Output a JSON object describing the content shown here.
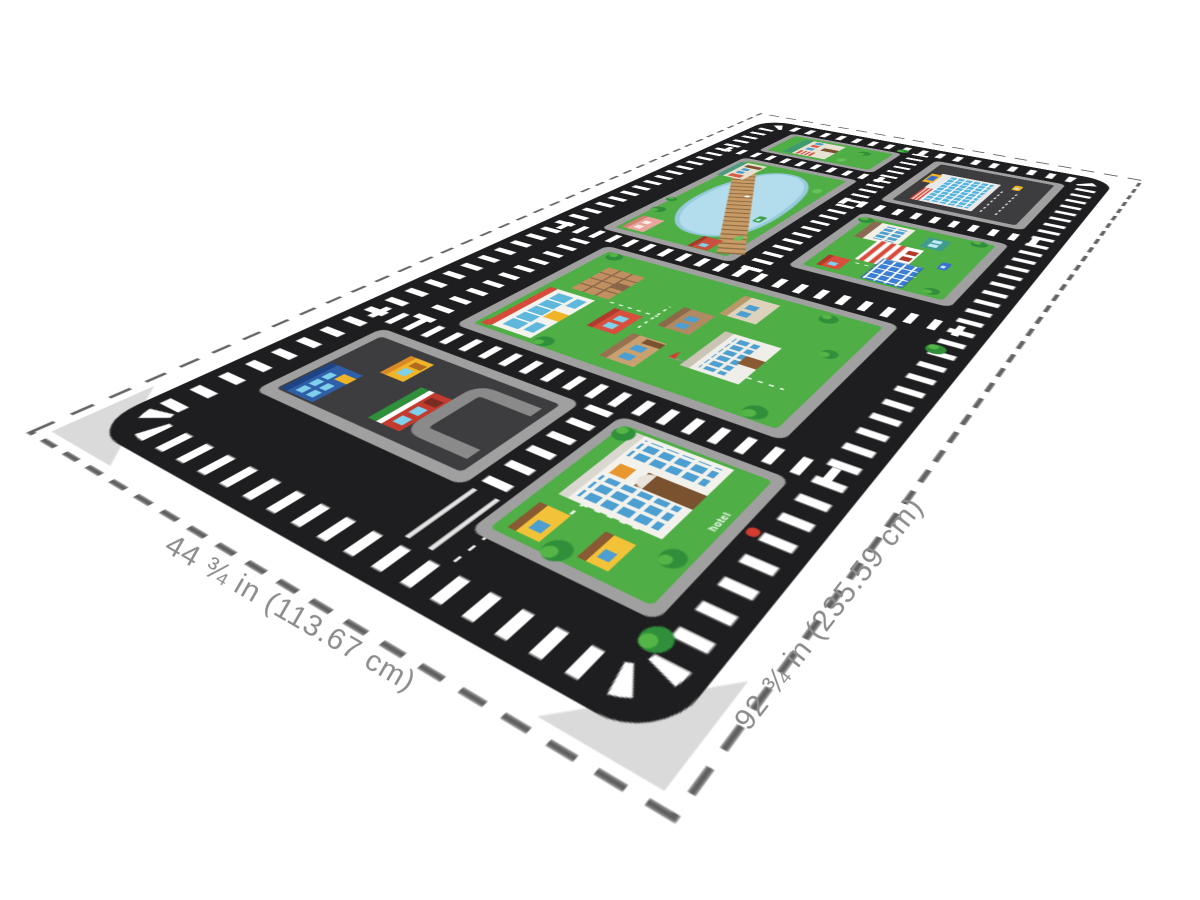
{
  "scene": {
    "type": "product-dimension-view",
    "background": "#ffffff"
  },
  "dimensions": {
    "width_label": "44 ¾ in (113.67 cm)",
    "length_label": "92 ¾ in (235.59 cm)"
  },
  "mat": {
    "labels": {
      "hotel": "hotel"
    },
    "features": [
      "parking-lot-block",
      "hotel-block",
      "city-center-block",
      "pond-park-block",
      "schoolhouse-block",
      "mall-block",
      "supermarket-block",
      "road-crosswalk-stripes",
      "boardwalk-bridge",
      "pond",
      "fire-hydrant"
    ],
    "colors": {
      "mat_black": "#1e1e20",
      "curb_gray": "#a0a0a0",
      "asphalt": "#3d3d40",
      "grass_green": "#4fae45",
      "pond_blue": "#b3dded",
      "boardwalk_tan": "#c89b66",
      "stripe_white": "#ffffff",
      "dashed_border": "#606060",
      "label_gray": "#8c8c8c",
      "accent_red": "#d84a3a",
      "accent_blue": "#4c9fd0",
      "accent_yellow": "#f0b429"
    }
  }
}
